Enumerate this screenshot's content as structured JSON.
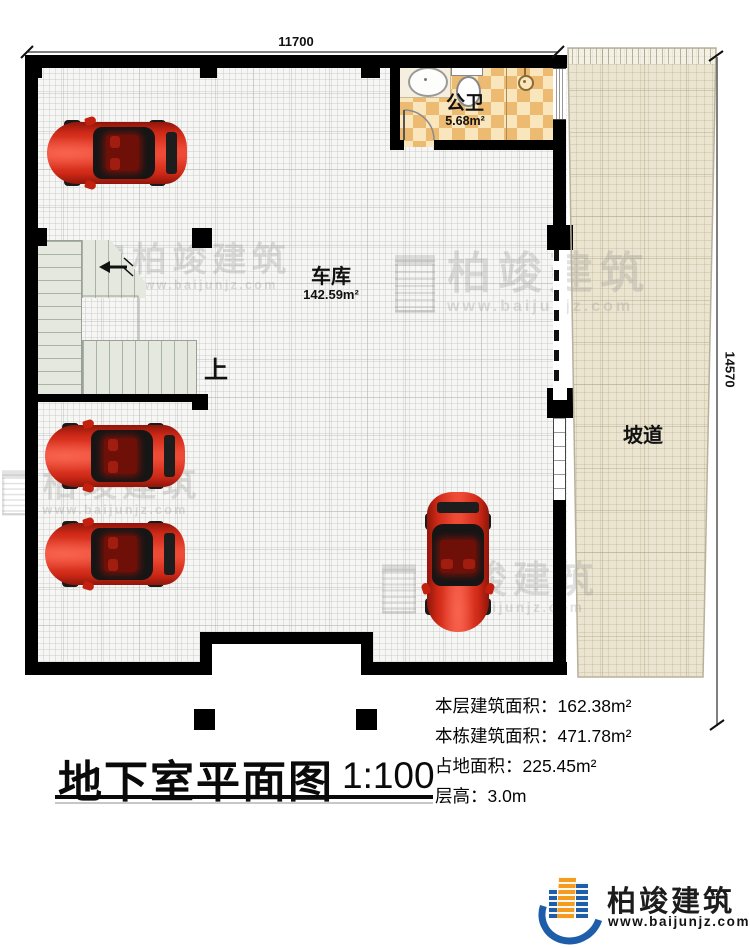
{
  "plan": {
    "dimensions": {
      "top": "11700",
      "right": "14570"
    },
    "garage": {
      "name": "车库",
      "area": "142.59m²"
    },
    "bathroom": {
      "name": "公卫",
      "area": "5.68m²"
    },
    "ramp": {
      "name": "坡道"
    },
    "stairs": {
      "direction_label": "上"
    }
  },
  "title_block": {
    "title": "地下室平面图",
    "scale": "1:100",
    "info_lines": [
      "本层建筑面积：162.38m²",
      "本栋建筑面积：471.78m²",
      "占地面积：225.45m²",
      "层高：3.0m"
    ]
  },
  "branding": {
    "name": "柏竣建筑",
    "website": "www.baijunjz.com"
  },
  "watermark": {
    "text": "柏竣建筑",
    "subtext": "www.baijunjz.com"
  },
  "colors": {
    "wall": "#000000",
    "ramp_fill": "#eae4d0",
    "tile_dark": "#edba72",
    "tile_light": "#f9e6bd",
    "stair_fill": "#e4e8df",
    "car_red": "#d6291a",
    "brand_blue": "#1d5da9",
    "brand_orange": "#f59c1f"
  }
}
